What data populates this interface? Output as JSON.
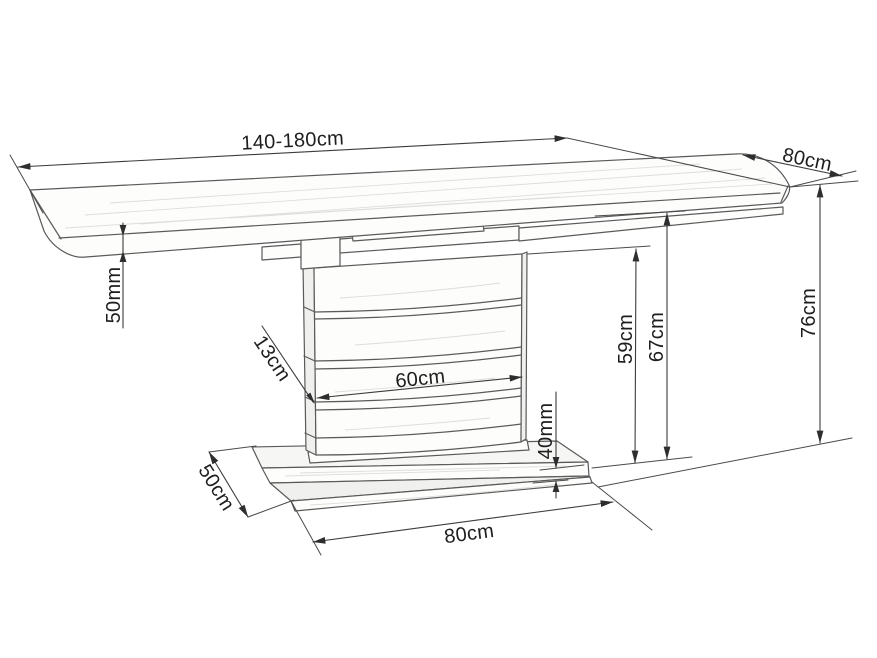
{
  "diagram": {
    "subject": "extendable pedestal table technical drawing",
    "colors": {
      "line": "#5a5a5a",
      "dimension_line": "#3c3c3c",
      "label_text": "#1e1e1e",
      "background": "#ffffff",
      "wood_grain": "#ddddd9"
    },
    "dimensions": [
      {
        "id": "top-length",
        "label": "140-180cm",
        "measures": "tabletop length (extendable)"
      },
      {
        "id": "top-depth",
        "label": "80cm",
        "measures": "tabletop depth"
      },
      {
        "id": "overall-height",
        "label": "76cm",
        "measures": "overall table height"
      },
      {
        "id": "underframe-height",
        "label": "67cm",
        "measures": "floor to underframe"
      },
      {
        "id": "column-height",
        "label": "59cm",
        "measures": "pedestal column height"
      },
      {
        "id": "top-thickness",
        "label": "50mm",
        "measures": "tabletop thickness"
      },
      {
        "id": "column-thickness",
        "label": "13cm",
        "measures": "pedestal column thickness"
      },
      {
        "id": "column-width",
        "label": "60cm",
        "measures": "pedestal column width"
      },
      {
        "id": "base-thickness",
        "label": "40mm",
        "measures": "base plate thickness"
      },
      {
        "id": "base-depth",
        "label": "50cm",
        "measures": "base plate depth"
      },
      {
        "id": "base-width",
        "label": "80cm",
        "measures": "base plate width"
      }
    ]
  }
}
